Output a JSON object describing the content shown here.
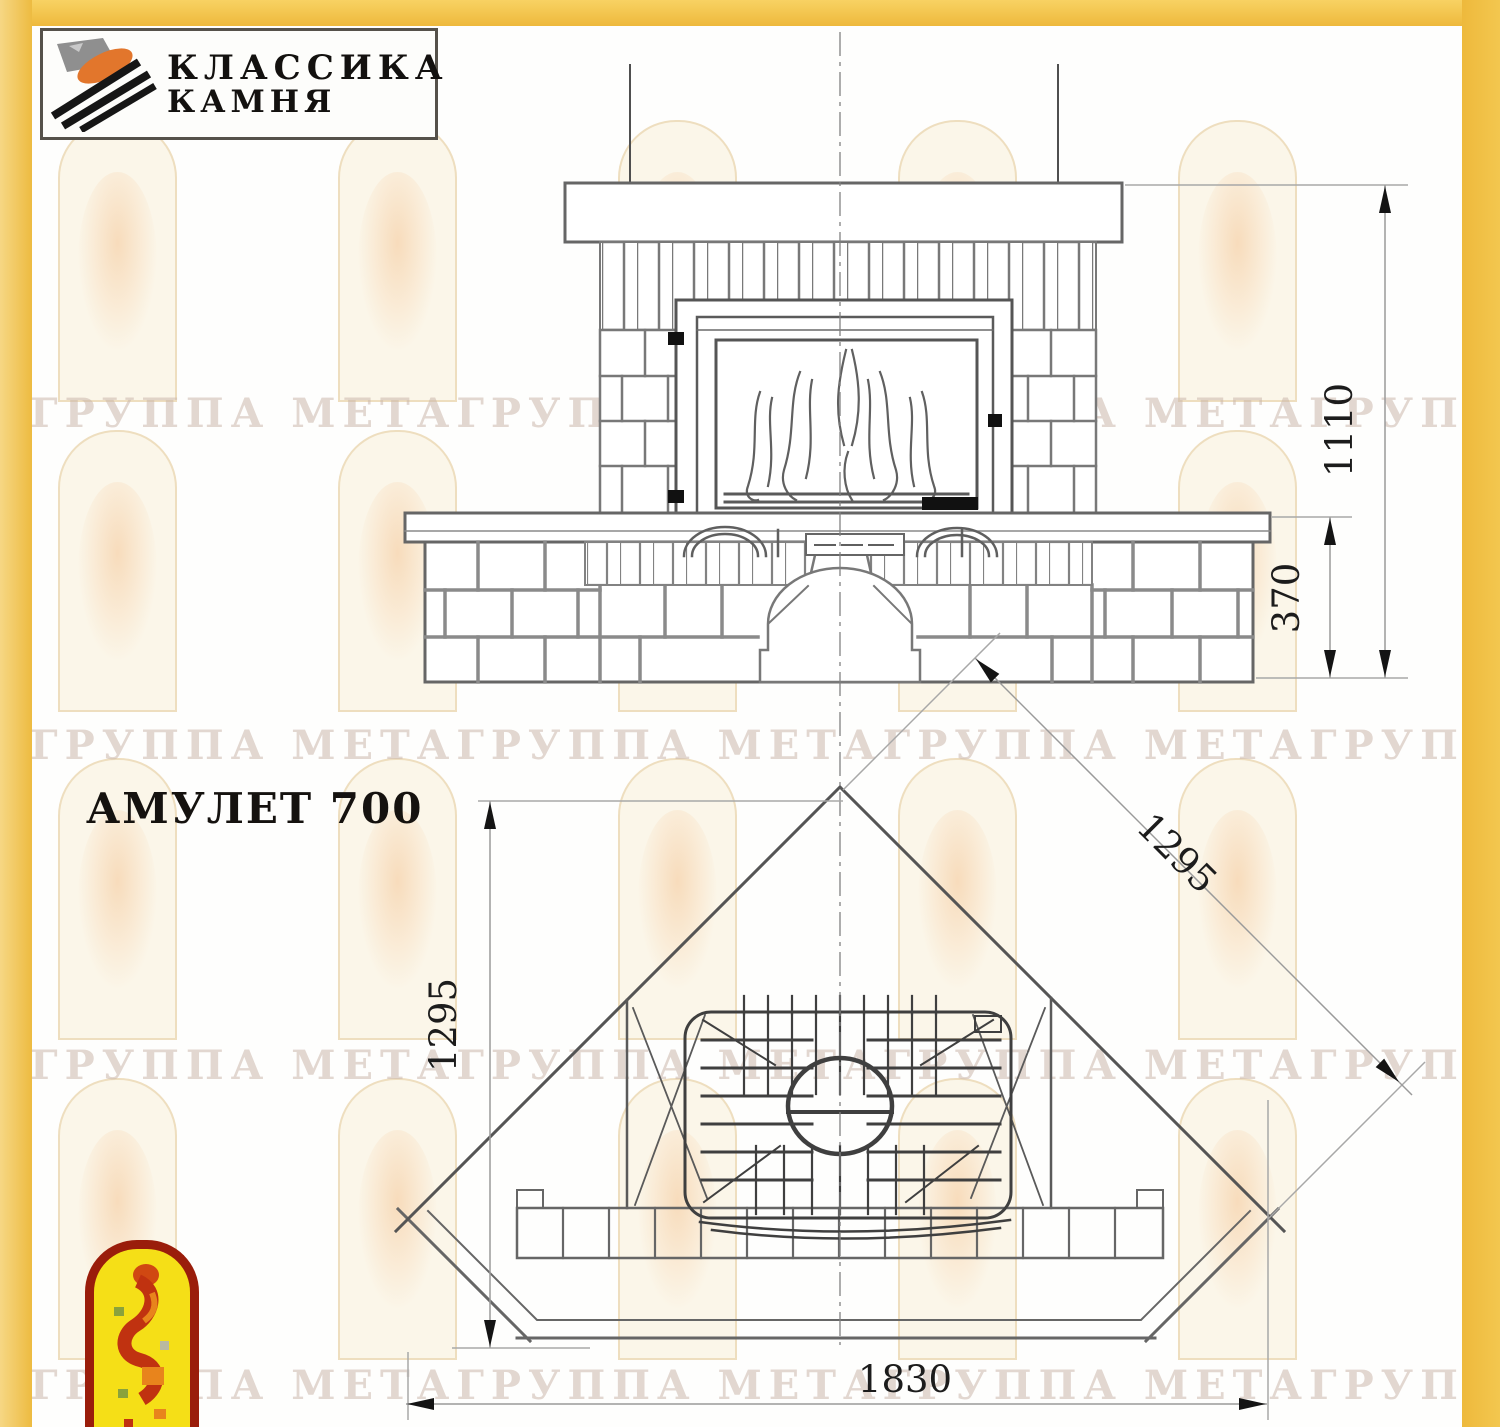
{
  "branding": {
    "logo_line1": "КЛАССИКА",
    "logo_line2": "КАМНЯ"
  },
  "title": "АМУЛЕТ 700",
  "watermark": {
    "text": "ГРУППА МЕТАГРУППА МЕТАГРУППА МЕТАГРУППА МЕТА"
  },
  "dimensions": {
    "front": {
      "total_height": "1110",
      "plinth_height": "370"
    },
    "plan": {
      "left_depth": "1295",
      "right_depth": "1295",
      "total_width": "1830"
    }
  },
  "colors": {
    "frame_yellow": "#f0c14a",
    "drawing_line": "#6e6e6e",
    "dimension_text": "#1c1c1c",
    "emblem_red": "#9a1d0b",
    "emblem_yellow": "#f5df17"
  }
}
